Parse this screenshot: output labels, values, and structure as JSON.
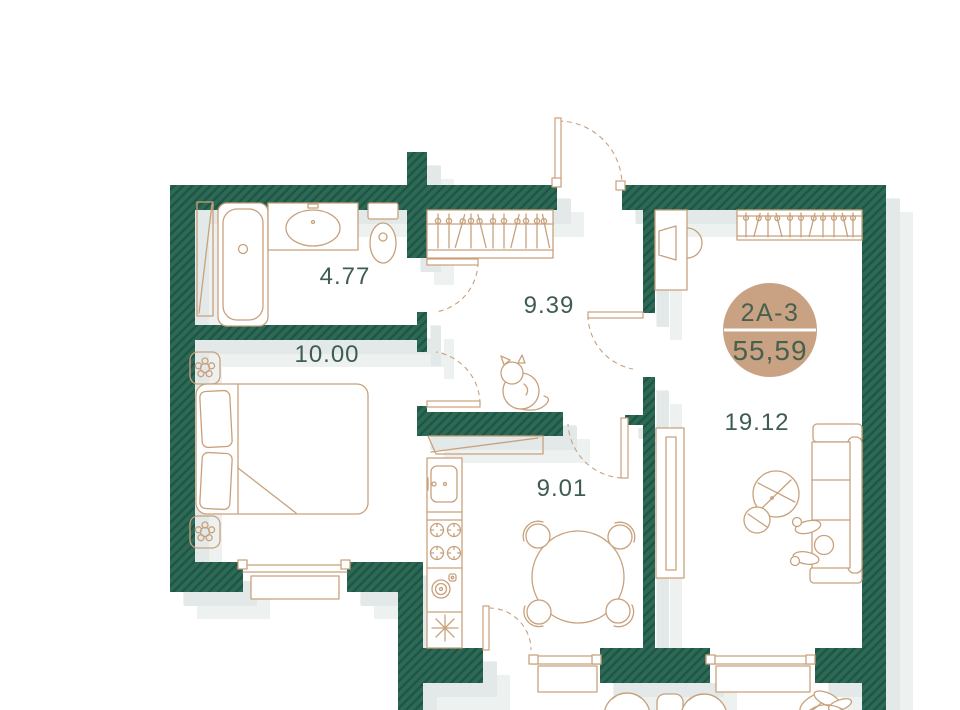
{
  "floor_plan": {
    "badge": {
      "unit_number": "2А-3",
      "total_area": "55,59"
    },
    "rooms": {
      "bathroom": {
        "area": "4.77",
        "furniture": [
          "bathtub",
          "sink",
          "toilet",
          "tall-panel"
        ]
      },
      "bedroom": {
        "area": "10.00",
        "furniture": [
          "double-bed",
          "nightstand",
          "nightstand",
          "window"
        ]
      },
      "hallway": {
        "area": "9.39",
        "furniture": [
          "closet-hangers",
          "cat"
        ]
      },
      "kitchen": {
        "area": "9.01",
        "furniture": [
          "counter",
          "kitchen-sink",
          "stove",
          "oven",
          "dining-table",
          "chairs",
          "window",
          "balcony-door"
        ]
      },
      "living_room": {
        "area": "19.12",
        "furniture": [
          "desk",
          "desk-chair",
          "wardrobe-hangers",
          "tv-console",
          "coffee-table",
          "sofa",
          "person",
          "window"
        ]
      },
      "balcony": {
        "area": "",
        "furniture": [
          "chair",
          "table",
          "chair",
          "plant"
        ]
      }
    },
    "colors": {
      "wall_fill": "#2e6956",
      "wall_hatch": "#1e5646",
      "furniture_outline": "#c8a17c",
      "label_text": "#3f5c52",
      "badge_fill": "#c9a183",
      "badge_text": "#47614f",
      "background": "#ffffff",
      "shadow": "#e3e9e8"
    }
  }
}
